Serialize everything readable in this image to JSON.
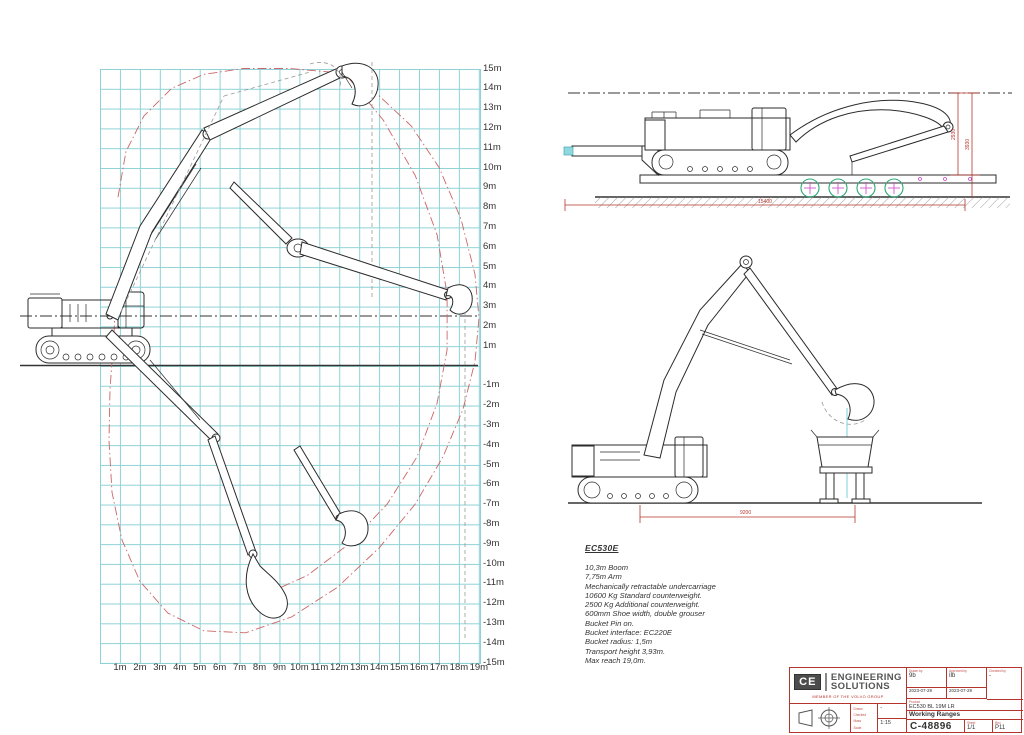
{
  "chart_data": {
    "type": "line",
    "title": "Working Ranges",
    "xlabel": "reach (m)",
    "ylabel": "height (m)",
    "xlim": [
      0,
      19
    ],
    "ylim": [
      -15,
      15
    ],
    "grid": true,
    "units": "m",
    "x_ticks": [
      "1m",
      "2m",
      "3m",
      "4m",
      "5m",
      "6m",
      "7m",
      "8m",
      "9m",
      "10m",
      "11m",
      "12m",
      "13m",
      "14m",
      "15m",
      "16m",
      "17m",
      "18m",
      "19m"
    ],
    "y_ticks": [
      "15m",
      "14m",
      "13m",
      "12m",
      "11m",
      "10m",
      "9m",
      "8m",
      "7m",
      "6m",
      "5m",
      "4m",
      "3m",
      "2m",
      "1m",
      "",
      "-1m",
      "-2m",
      "-3m",
      "-4m",
      "-5m",
      "-6m",
      "-7m",
      "-8m",
      "-9m",
      "-10m",
      "-11m",
      "-12m",
      "-13m",
      "-14m",
      "-15m"
    ],
    "reference_height_m": 2.5,
    "max_reach_m": 19.0,
    "max_height_m": 15.0,
    "max_depth_m": -13.5,
    "envelope_outer": [
      [
        0.9,
        8.5
      ],
      [
        1.3,
        10.8
      ],
      [
        2.2,
        12.6
      ],
      [
        3.6,
        14.0
      ],
      [
        5.2,
        14.7
      ],
      [
        7.2,
        15.0
      ],
      [
        9.5,
        15.0
      ],
      [
        11.8,
        14.8
      ],
      [
        13.8,
        13.8
      ],
      [
        15.6,
        12.1
      ],
      [
        17.0,
        10.0
      ],
      [
        18.1,
        7.4
      ],
      [
        18.8,
        4.6
      ],
      [
        19.0,
        2.4
      ],
      [
        18.8,
        0.2
      ],
      [
        18.2,
        -2.2
      ],
      [
        17.2,
        -4.6
      ],
      [
        15.8,
        -7.0
      ],
      [
        14.0,
        -9.2
      ],
      [
        11.9,
        -11.2
      ],
      [
        9.6,
        -12.7
      ],
      [
        7.3,
        -13.5
      ],
      [
        5.2,
        -13.4
      ],
      [
        3.4,
        -12.5
      ],
      [
        2.0,
        -10.9
      ],
      [
        1.1,
        -8.8
      ],
      [
        0.6,
        -6.4
      ],
      [
        0.45,
        -3.8
      ],
      [
        0.5,
        -1.2
      ],
      [
        0.7,
        1.6
      ],
      [
        0.8,
        4.0
      ]
    ],
    "envelope_inner": [
      [
        12.4,
        14.6
      ],
      [
        14.2,
        12.4
      ],
      [
        15.8,
        9.6
      ],
      [
        16.9,
        6.6
      ],
      [
        17.4,
        3.6
      ],
      [
        17.4,
        0.8
      ],
      [
        16.9,
        -1.9
      ],
      [
        15.9,
        -4.6
      ],
      [
        14.4,
        -7.0
      ],
      [
        12.5,
        -9.0
      ],
      [
        10.4,
        -10.6
      ],
      [
        8.2,
        -11.6
      ]
    ],
    "colors": {
      "grid": "#8ed2d6",
      "envelope": "#cc6666",
      "drawing": "#2b2b2b"
    }
  },
  "transport_view": {
    "dim_inner": "2930",
    "dim_outer": "3930",
    "dim_length": "15400"
  },
  "loading_view": {
    "dim_length": "9200"
  },
  "spec": {
    "title": "EC530E",
    "lines": [
      "10,3m Boom",
      "7,75m Arm",
      "Mechanically retractable undercarriage",
      "10600 Kg Standard counterweight.",
      "2500 Kg Additional counterweight.",
      "600mm Shoe width, double grouser",
      "Bucket Pin on.",
      "Bucket interface: EC220E",
      "Bucket radius: 1,5m",
      "Transport height 3,93m.",
      "Max reach 19,0m."
    ]
  },
  "title_block": {
    "logo": {
      "initials": "CE",
      "line1": "ENGINEERING",
      "line2": "SOLUTIONS",
      "tagline": "MEMBER OF THE VOLVO GROUP"
    },
    "fields": {
      "drawn_label": "Drawn by",
      "drawn_value": "9b",
      "approved_label": "Approved by",
      "approved_value": "Ilb",
      "checked_label": "Checked by",
      "checked_value": "-",
      "date1": "2023-07-29",
      "date2": "2023-07-29",
      "product_label": "Product",
      "product_value": "EC530 BL 19M LR",
      "title_label": "Title",
      "title_value": "Working Ranges",
      "number_label": "Document number",
      "number_value": "C-48896",
      "sheet_label": "Sheet",
      "sheet_value": "1/1",
      "rev_label": "Rev",
      "rev_value": "P11",
      "mass_value": "-",
      "scale_value": "1:15",
      "side_labels": [
        "Drawn",
        "Checked",
        "Mass",
        "Scale"
      ]
    },
    "colors": {
      "frame": "#b5342b"
    }
  }
}
